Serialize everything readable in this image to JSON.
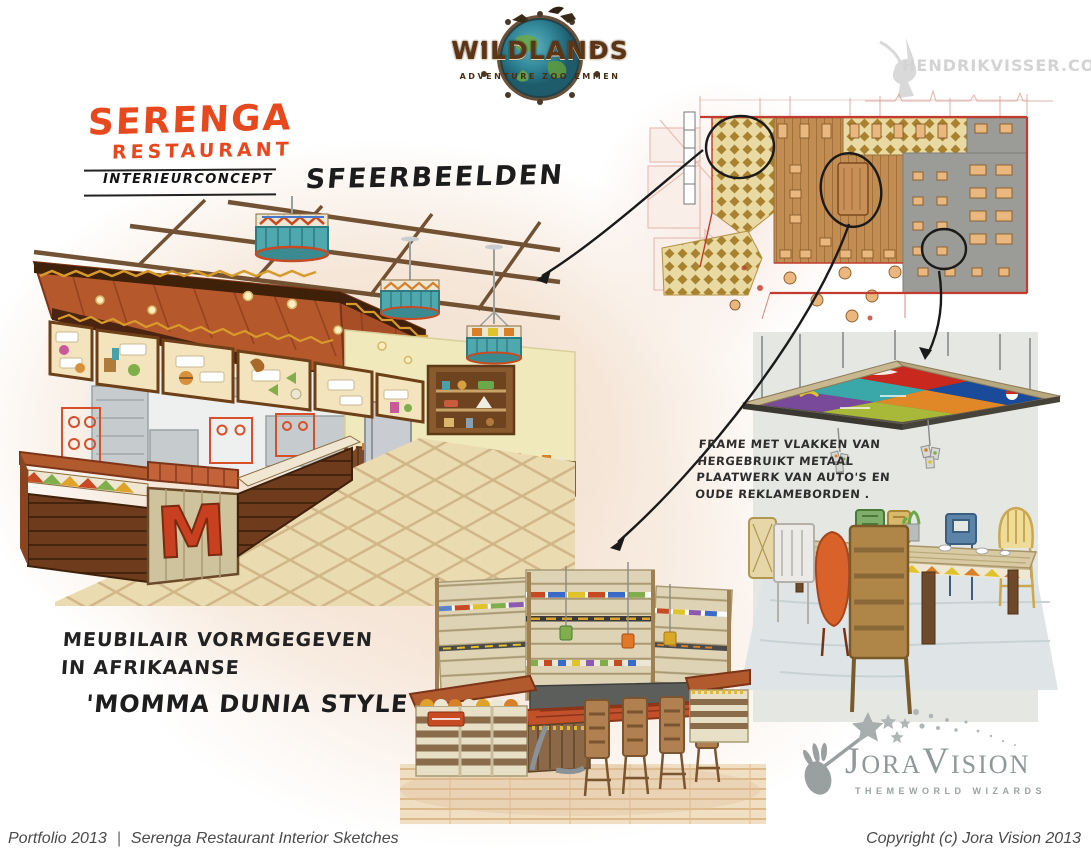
{
  "colors": {
    "accent_orange": "#e8481d",
    "plan_red": "#c23b2f",
    "peach_background": "#f3e0d2",
    "gray_panel": "#e5e7e2",
    "sketch_ink": "#1a1a1a"
  },
  "header": {
    "wildlands_name": "WILDLANDS",
    "wildlands_tagline": "ADVENTURE ZOO EMMEN",
    "watermark": "HENDRIKVISSER.COM"
  },
  "brand": {
    "title": "SERENGA",
    "subtitle": "RESTAURANT",
    "concept": "INTERIEURCONCEPT"
  },
  "heading": {
    "sfeerbeelden": "SFEERBEELDEN"
  },
  "notes": {
    "frame": [
      "FRAME MET VLAKKEN VAN",
      "HERGEBRUIKT METAAL",
      "PLAATWERK VAN AUTO'S EN",
      "OUDE REKLAMEBORDEN ."
    ],
    "furniture": [
      "MEUBILAIR VORMGEGEVEN",
      "IN AFRIKAANSE"
    ],
    "furniture_style": "'MOMMA DUNIA STYLE"
  },
  "sketch": {
    "counter_monogram": "M"
  },
  "joravision": {
    "name": "JoraVision",
    "tagline": "THEMEWORLD WIZARDS"
  },
  "footer": {
    "portfolio": "Portfolio 2013",
    "separator": "|",
    "title": "Serenga Restaurant Interior Sketches",
    "copyright": "Copyright (c) Jora Vision 2013"
  }
}
